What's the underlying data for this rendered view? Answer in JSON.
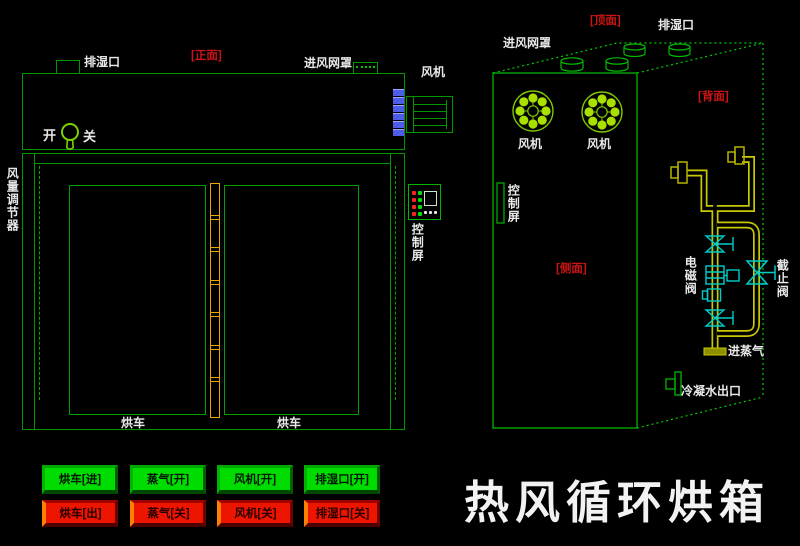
{
  "title": "热风循环烘箱",
  "front_view": {
    "view_label": "[正面]",
    "exhaust_port_label": "排湿口",
    "inlet_mesh_label": "进风网罩",
    "fan_label": "风机",
    "switch_on_label": "开",
    "switch_off_label": "关",
    "air_regulator_label": "风量调节器",
    "control_screen_label": "控制屏",
    "cart_left_label": "烘车",
    "cart_right_label": "烘车"
  },
  "perspective_view": {
    "top_label": "[顶面]",
    "back_label": "[背面]",
    "side_label": "[侧面]",
    "exhaust_port_label": "排湿口",
    "inlet_mesh_label": "进风网罩",
    "fan1_label": "风机",
    "fan2_label": "风机",
    "control_screen_label": "控制屏",
    "solenoid_valve_label": "电磁阀",
    "stop_valve_label": "截止阀",
    "steam_inlet_label": "进蒸气",
    "condensate_outlet_label": "冷凝水出口"
  },
  "control_buttons": {
    "on_row": [
      "烘车[进]",
      "蒸气[开]",
      "风机[开]",
      "排湿口[开]"
    ],
    "off_row": [
      "烘车[出]",
      "蒸气[关]",
      "风机[关]",
      "排湿口[关]"
    ]
  },
  "icons": {
    "power_key_switch": "keyhole-shape",
    "fan_impeller": "circle-with-8-dot-blades",
    "angle_valve": "vertical-bowtie-with-t-handle",
    "stop_valve": "bowtie-with-t-handle",
    "solenoid_valve": "coil-block-with-junction-box",
    "pipe_flange": "flange-with-stub",
    "vent_cylinder": "cylinder-stub"
  },
  "colors": {
    "background": "#000000",
    "outline_green": "#009600",
    "bright_green": "#00c800",
    "fan_blade_green": "#a8e000",
    "hinge_yellow": "#e8a800",
    "pipe_yellow": "#c8c800",
    "valve_cyan": "#00cccc",
    "louver_blue": "#4a5ce8",
    "label_red": "#cc1414",
    "label_white": "#e8e8e8",
    "button_on_green": "#00dc00",
    "button_off_red": "#ee1500"
  }
}
